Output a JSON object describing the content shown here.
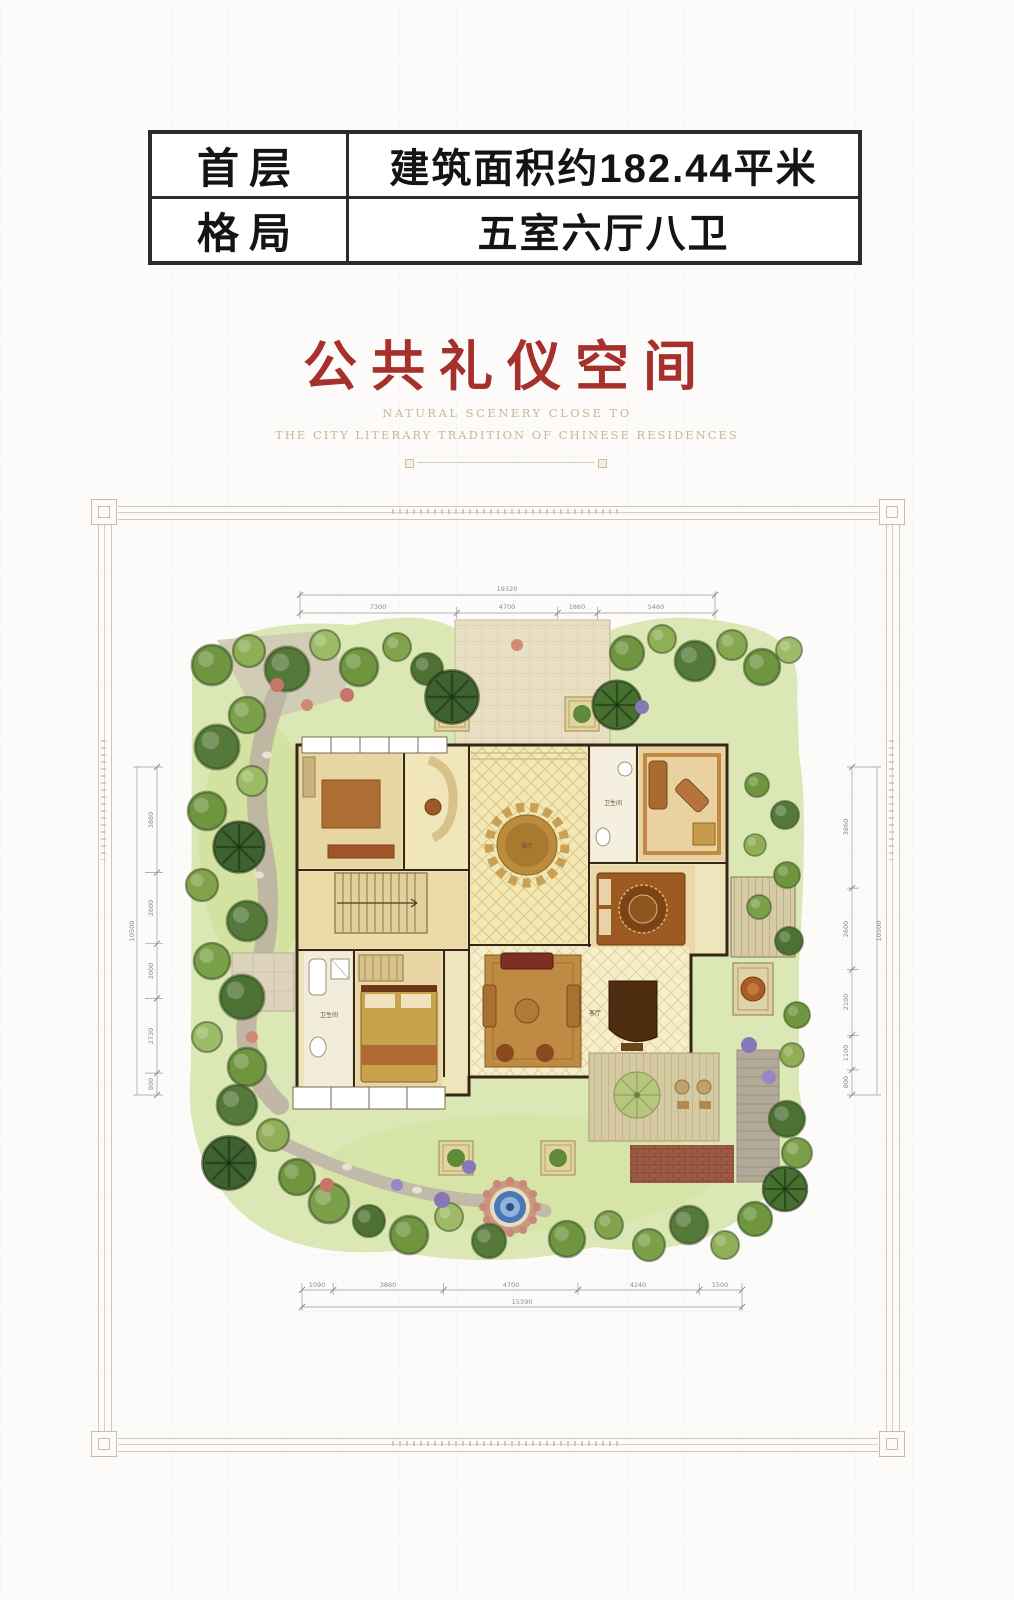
{
  "header_table": {
    "rows": [
      {
        "label": "首层",
        "value": "建筑面积约182.44平米"
      },
      {
        "label": "格局",
        "value": "五室六厅八卫"
      }
    ]
  },
  "title": {
    "text": "公共礼仪空间"
  },
  "tagline": {
    "line1": "NATURAL SCENERY CLOSE TO",
    "line2": "THE CITY LITERARY TRADITION OF CHINESE RESIDENCES"
  },
  "floor_plan": {
    "labels": {
      "bathroom_upper": "卫生间",
      "bathroom_lower": "卫生间",
      "dining": "餐厅",
      "living": "客厅"
    },
    "dims": {
      "top": {
        "total": "19320",
        "segments": [
          "7300",
          "4700",
          "1860",
          "5460"
        ]
      },
      "bottom": {
        "total": "15390",
        "segments": [
          "1090",
          "3860",
          "4700",
          "4240",
          "1500"
        ]
      },
      "left": {
        "total": "10500",
        "segments": [
          "3860",
          "2600",
          "2000",
          "2730",
          "800"
        ]
      },
      "right": {
        "total": "10500",
        "segments": [
          "3860",
          "2600",
          "2100",
          "1100",
          "800"
        ]
      }
    }
  },
  "palette": {
    "title_red": "#a5302c",
    "tagline_tan": "#c7b897",
    "frame_gray": "#c9c1b1",
    "tree_green": "#6f953f",
    "lawn_green": "#d7e4a8",
    "floor_beige": "#efe5bc",
    "wood_brown": "#c08a44",
    "wall_dark": "#352619",
    "water_blue": "#3f6fae",
    "terrace_brick": "#9d5b45"
  }
}
